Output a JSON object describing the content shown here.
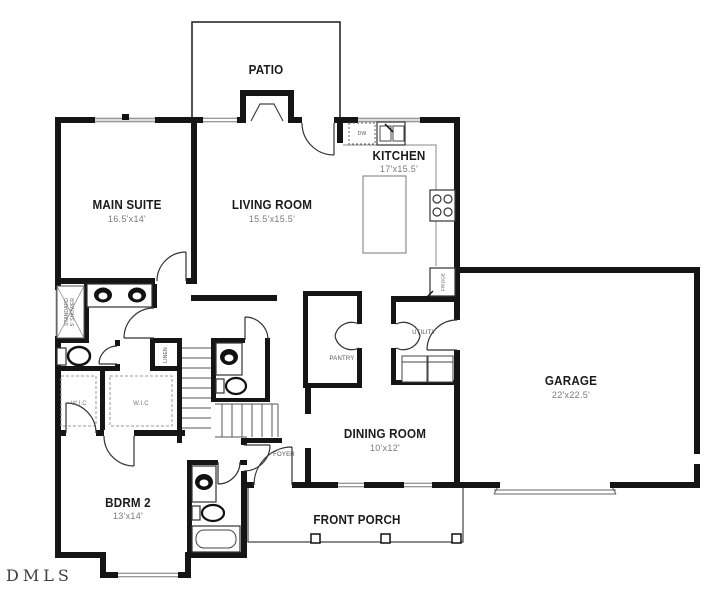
{
  "watermark": "DMLS",
  "rooms": {
    "patio": {
      "name": "PATIO"
    },
    "main_suite": {
      "name": "MAIN SUITE",
      "dims": "16.5'x14'"
    },
    "living_room": {
      "name": "LIVING ROOM",
      "dims": "15.5'x15.5'"
    },
    "kitchen": {
      "name": "KITCHEN",
      "dims": "17'x15.5'"
    },
    "garage": {
      "name": "GARAGE",
      "dims": "22'x22.5'"
    },
    "dining_room": {
      "name": "DINING ROOM",
      "dims": "10'x12'"
    },
    "bdrm2": {
      "name": "BDRM 2",
      "dims": "13'x14'"
    },
    "front_porch": {
      "name": "FRONT PORCH"
    },
    "foyer": {
      "name": "FOYER"
    }
  },
  "closets_fixtures": {
    "pantry": "PANTRY",
    "utility": "UTILITY",
    "linen": "LINEN",
    "wic_1": "W.I.C",
    "wic_2": "W.I.C",
    "shower_line1": "STANDARD",
    "shower_line2": "5' SHOWER",
    "dishwasher": "DW",
    "fridge": "FRIDGE"
  }
}
